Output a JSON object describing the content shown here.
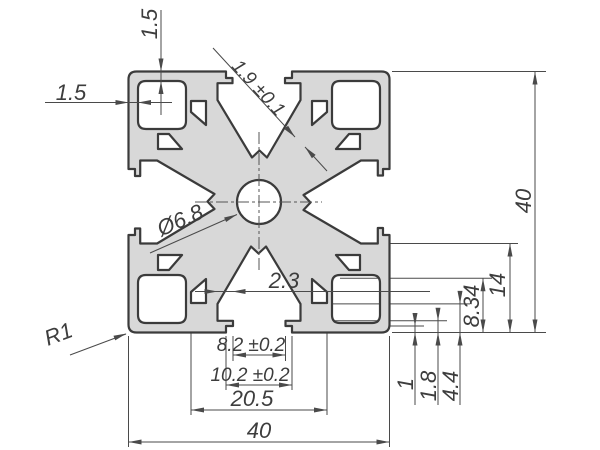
{
  "drawing": {
    "type": "technical-drawing",
    "subject": "aluminium-extrusion-profile-40x40-cross-section",
    "colors": {
      "background": "#ffffff",
      "profile_fill": "#d8d8d8",
      "profile_outline": "#3b3b3b",
      "dimension_lines": "#4a4a4a",
      "text": "#3d3d3d"
    },
    "labels": {
      "overall_width_bottom": "40",
      "overall_height_right": "40",
      "slot_cavity_width": "20.5",
      "slot_mouth_width": "10.2 ±0.2",
      "slot_opening_width": "8.2 ±0.2",
      "slot_wall_thickness": "2.3",
      "height_14": "14",
      "height_8_34": "8.34",
      "height_4_4": "4.4",
      "height_1_8": "1.8",
      "height_1": "1",
      "wall_left_thickness": "1.5",
      "wall_top_thickness": "1.5",
      "web_thickness": "1.9 ±0.1",
      "center_hole_diameter": "Ø6.8",
      "corner_radius": "R1"
    }
  }
}
